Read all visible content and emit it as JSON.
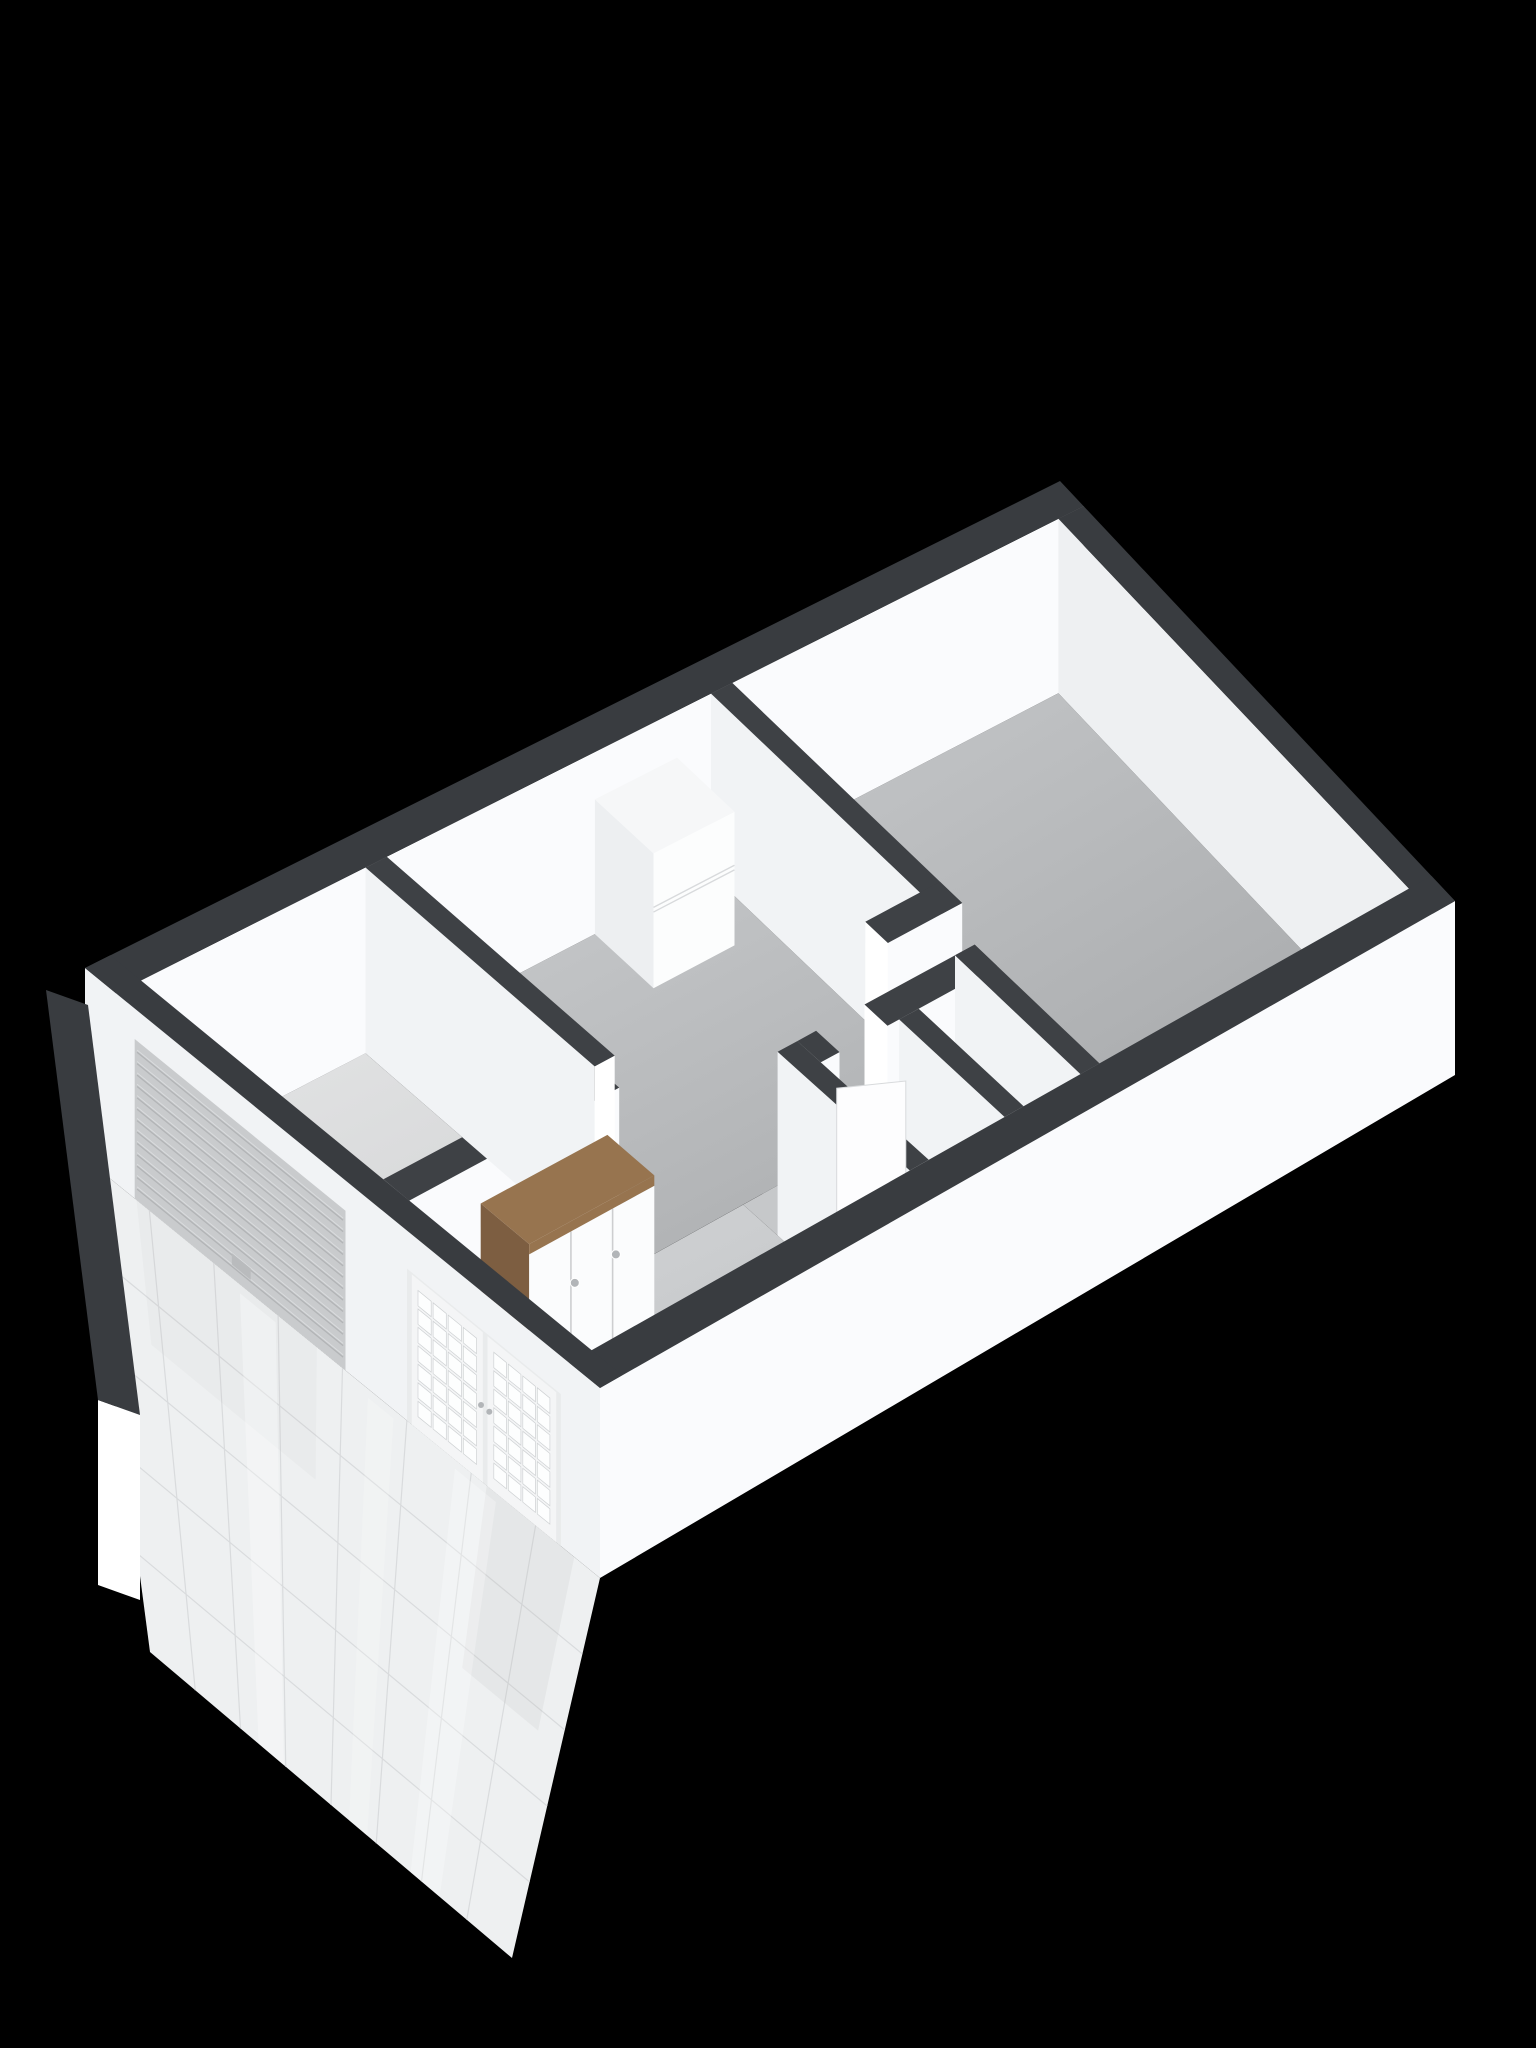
{
  "title": "3D dollhouse floor plan render",
  "background": "#000000",
  "palette": {
    "cap": "#393c40",
    "cap_interior": "#3e4145",
    "face_se": "#fafbfd",
    "face_sw": "#f1f3f5",
    "face_end": "#ffffff",
    "face_far": "#eef0f2",
    "floor_back_light": "#c6c8ca",
    "floor_back_dark": "#a4a6a8",
    "floor_mid_light": "#c9cbcd",
    "floor_mid_dark": "#aeb0b2",
    "floor_hall_light": "#d3d5d7",
    "floor_hall_dark": "#bfc1c3",
    "floor_garage_light": "#e3e4e5",
    "floor_garage_dark": "#d2d3d4",
    "floor_toilet": "#d3d5d6",
    "floor_strip": "#c6c8ca",
    "patio_tile": "#eef0f1",
    "patio_joint": "#d9dbdd",
    "roller_face": "#c9cbcd",
    "roller_slat": "#b2b4b6",
    "roller_highlight": "#dcdee0",
    "door_frame": "#f4f5f6",
    "door_leaf": "#e9ebec",
    "pane": "#fdfefe",
    "pane_line": "#cfd2d4",
    "handle": "#b2b5b8",
    "wood_top": "#97744f",
    "wood_side": "#7d5e41",
    "wardrobe_door": "#fbfcfd",
    "wardrobe_gap": "#cdced0",
    "cabinet_front": "#fcfdfd",
    "cabinet_side": "#edeff1",
    "cabinet_top": "#f6f7f8",
    "cabinet_seam": "#d8dadc",
    "cube_top": "#f8f9fa",
    "cube_sw": "#e9ebed",
    "cube_se": "#f1f3f4",
    "radiator": "#f4f5f6",
    "radiator_shade": "#e8eaec"
  },
  "camera": {
    "W": [
      85,
      1158
    ],
    "N": [
      1060,
      655
    ],
    "S": [
      600,
      1578
    ],
    "E": [
      1455,
      1075
    ],
    "uMax": 10,
    "vMax": 4.35,
    "wallHeightPx": 190,
    "heightTaper": 16
  },
  "floors": [
    {
      "name": "back-room-floor",
      "u1": 6.37,
      "v1": 0.26,
      "u2": 9.74,
      "v2": 4.09,
      "grad": [
        "floor_back_light",
        "floor_back_dark"
      ]
    },
    {
      "name": "back-room-notch-floor",
      "u1": 5.55,
      "v1": 2.54,
      "u2": 6.37,
      "v2": 4.09,
      "grad": [
        "floor_back_light",
        "floor_back_dark"
      ]
    },
    {
      "name": "middle-corridor-floor",
      "u1": 2.8,
      "v1": 0.26,
      "u2": 6.15,
      "v2": 2.54,
      "grad": [
        "floor_mid_light",
        "floor_mid_dark"
      ]
    },
    {
      "name": "toilet-room-floor",
      "u1": 4.17,
      "v1": 2.86,
      "u2": 6.15,
      "v2": 4.09,
      "fill": "floor_toilet"
    },
    {
      "name": "entry-hall-floor",
      "u1": 0.26,
      "v1": 2.54,
      "u2": 3.95,
      "v2": 4.09,
      "grad": [
        "floor_hall_light",
        "floor_hall_dark"
      ]
    },
    {
      "name": "hall-passage-floor",
      "u1": 3.95,
      "v1": 2.54,
      "u2": 5.55,
      "v2": 2.86,
      "fill": "floor_strip"
    },
    {
      "name": "garage-floor",
      "u1": 0.26,
      "v1": 0.26,
      "u2": 2.58,
      "v2": 2.32,
      "grad": [
        "floor_garage_light",
        "floor_garage_dark"
      ]
    }
  ],
  "walls": [
    {
      "name": "exterior-wall-nw",
      "u1": 0,
      "u2": 10,
      "v1": 0,
      "v2": 0.26,
      "faces": [
        "se",
        "cap"
      ],
      "seFill": "face_se"
    },
    {
      "name": "exterior-wall-ne",
      "u1": 9.74,
      "u2": 10,
      "v1": 0.26,
      "v2": 4.35,
      "faces": [
        "sw",
        "cap"
      ],
      "swFill": "face_far"
    },
    {
      "name": "partition-backroom",
      "u1": 6.15,
      "u2": 6.37,
      "v1": 0.26,
      "v2": 2.54,
      "faces": [
        "sw",
        "cap"
      ]
    },
    {
      "name": "partition-l-leg",
      "u1": 5.55,
      "u2": 6.37,
      "v1": 2.32,
      "v2": 2.54,
      "faces": [
        "endSW",
        "se",
        "cap"
      ]
    },
    {
      "name": "toilet-wall-nw-b",
      "u1": 4.92,
      "u2": 6.15,
      "v1": 2.86,
      "v2": 3.08,
      "faces": [
        "endSW",
        "se",
        "cap"
      ]
    },
    {
      "name": "toilet-wall-ne",
      "u1": 5.93,
      "u2": 6.15,
      "v1": 2.86,
      "v2": 4.09,
      "faces": [
        "sw",
        "cap"
      ]
    },
    {
      "name": "toilet-divider",
      "u1": 5.05,
      "u2": 5.27,
      "v1": 3.08,
      "v2": 4.09,
      "faces": [
        "sw",
        "cap"
      ]
    },
    {
      "name": "toilet-wall-nw-a",
      "u1": 4.17,
      "u2": 4.38,
      "v1": 2.86,
      "v2": 3.08,
      "faces": [
        "se",
        "cap"
      ]
    },
    {
      "name": "toilet-wall-sw",
      "u1": 3.95,
      "u2": 4.17,
      "v1": 2.86,
      "v2": 4.09,
      "faces": [
        "sw",
        "cap"
      ]
    },
    {
      "name": "spine-wall",
      "u1": 0.26,
      "u2": 2.58,
      "v1": 2.32,
      "v2": 2.54,
      "faces": [
        "se",
        "cap"
      ]
    },
    {
      "name": "garage-wall-ne",
      "u1": 2.58,
      "u2": 2.8,
      "v1": 0.26,
      "v2": 2.32,
      "faces": [
        "sw",
        "endSE",
        "cap"
      ]
    }
  ],
  "se_wall": {
    "name": "exterior-wall-se",
    "u1": 0,
    "u2": 10,
    "v1": 4.09,
    "v2": 4.35,
    "faces": [
      "se",
      "cap"
    ],
    "seFill": "face_se"
  },
  "facade": {
    "name": "facade-wall-sw",
    "u1": 0,
    "u2": 0.26,
    "v1": 0,
    "v2": 4.35,
    "faces": [
      "sw",
      "cap"
    ]
  },
  "roller_door": {
    "name": "garage-roller-door",
    "v1": 0.42,
    "v2": 2.2,
    "h": 0.84,
    "slats": 13,
    "handle": {
      "v1": 1.24,
      "v2": 1.4,
      "h1": 0.07,
      "h2": 0.13
    }
  },
  "french_doors": {
    "name": "french-doors",
    "v1": 2.72,
    "v2": 4.02,
    "h": 0.8,
    "leaves": [
      {
        "v1": 2.76,
        "v2": 3.36
      },
      {
        "v1": 3.4,
        "v2": 3.98
      }
    ],
    "cols": 4,
    "rows": 7,
    "frame": 0.045,
    "paneTop": 0.74,
    "handles": [
      {
        "v": 3.345,
        "h": 0.4
      },
      {
        "v": 3.415,
        "h": 0.4
      }
    ]
  },
  "furniture": {
    "cabinet": {
      "name": "tall-cabinet",
      "u1": 4.95,
      "u2": 5.8,
      "v1": 0.26,
      "v2": 0.82,
      "h": 0.74,
      "seams": [
        0.4,
        0.435
      ]
    },
    "wardrobe": {
      "name": "wardrobe",
      "u1": 1.05,
      "u2": 2.45,
      "v1": 2.54,
      "v2": 2.96,
      "h": 0.78,
      "doors": 3,
      "slabBand": 0.055,
      "handles": [
        {
          "u": 1.56,
          "h": 0.44
        },
        {
          "u": 2.02,
          "h": 0.47
        }
      ]
    },
    "toilet_cube": {
      "name": "toilet-block",
      "u1": 4.45,
      "u2": 4.82,
      "v1": 3.52,
      "v2": 3.9,
      "h": 0.28
    },
    "radiator": {
      "name": "radiator-ledge",
      "u1": 7.3,
      "u2": 7.85,
      "v1": 4.0,
      "v2": 4.09,
      "h1": 0.1,
      "h2": 0.36
    },
    "ajar_door": {
      "name": "interior-door-ajar",
      "a": [
        4.42,
        3.02
      ],
      "b": [
        4.96,
        3.22
      ],
      "h": 0.76
    }
  },
  "patio": {
    "name": "tiled-patio",
    "T1": [
      85,
      1158
    ],
    "T2": [
      600,
      1578
    ],
    "B1": [
      150,
      1652
    ],
    "B2": [
      512,
      1958
    ],
    "cols": 8,
    "rows": 5,
    "gloss": [
      {
        "s1": 0.3,
        "s2": 0.37,
        "o": 0.3
      },
      {
        "s1": 0.55,
        "s2": 0.6,
        "o": 0.2
      },
      {
        "s1": 0.72,
        "s2": 0.8,
        "o": 0.28
      }
    ],
    "reflections": [
      {
        "s1": 0.78,
        "s2": 0.95,
        "t1": 0.0,
        "t2": 0.45,
        "o": 0.14
      },
      {
        "s1": 0.1,
        "s2": 0.45,
        "t1": 0.0,
        "t2": 0.3,
        "o": 0.08
      }
    ]
  },
  "stub_wall": {
    "name": "patio-side-wall",
    "p1": [
      88,
      1190
    ],
    "p2": [
      140,
      1600
    ],
    "height": 185,
    "capOffset": [
      -42,
      -15
    ]
  }
}
